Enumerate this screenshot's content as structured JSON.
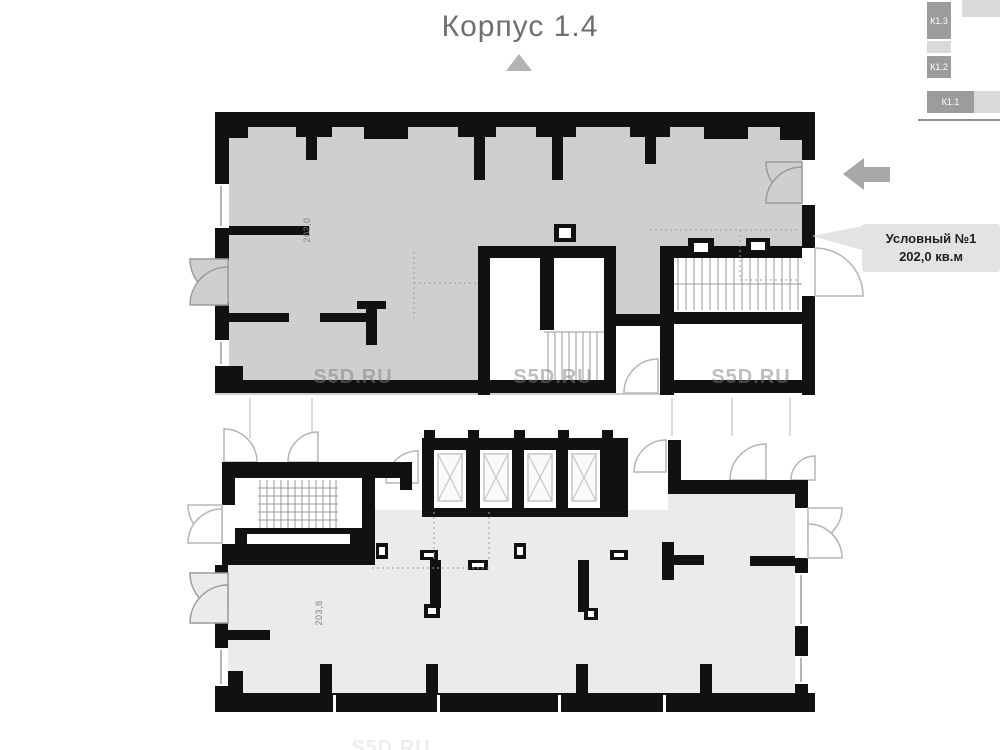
{
  "title": "Корпус 1.4",
  "minimap": {
    "blocks": [
      {
        "label": "К1.3"
      },
      {
        "label": "К1.2"
      },
      {
        "label": "К1.1"
      }
    ]
  },
  "callout": {
    "name": "Условный №1",
    "area": "202,0 кв.м"
  },
  "plan": {
    "upper_unit_area": "202,0",
    "lower_unit_area": "203,8"
  },
  "watermark": {
    "text": "S5D.RU"
  },
  "colors": {
    "unit_selected_fill": "#cfcfcf",
    "unit_other_fill": "#ebebeb",
    "wall": "#111111",
    "callout_bg": "#e3e3e3",
    "callout_text": "#222222",
    "arrow": "#a8a8a8",
    "minimap_block": "#9c9c9c",
    "minimap_light": "#d9d9d9",
    "watermark": "#7d7d7d",
    "title_text": "#6f6f6f",
    "door_arc": "#b5b5b5"
  }
}
